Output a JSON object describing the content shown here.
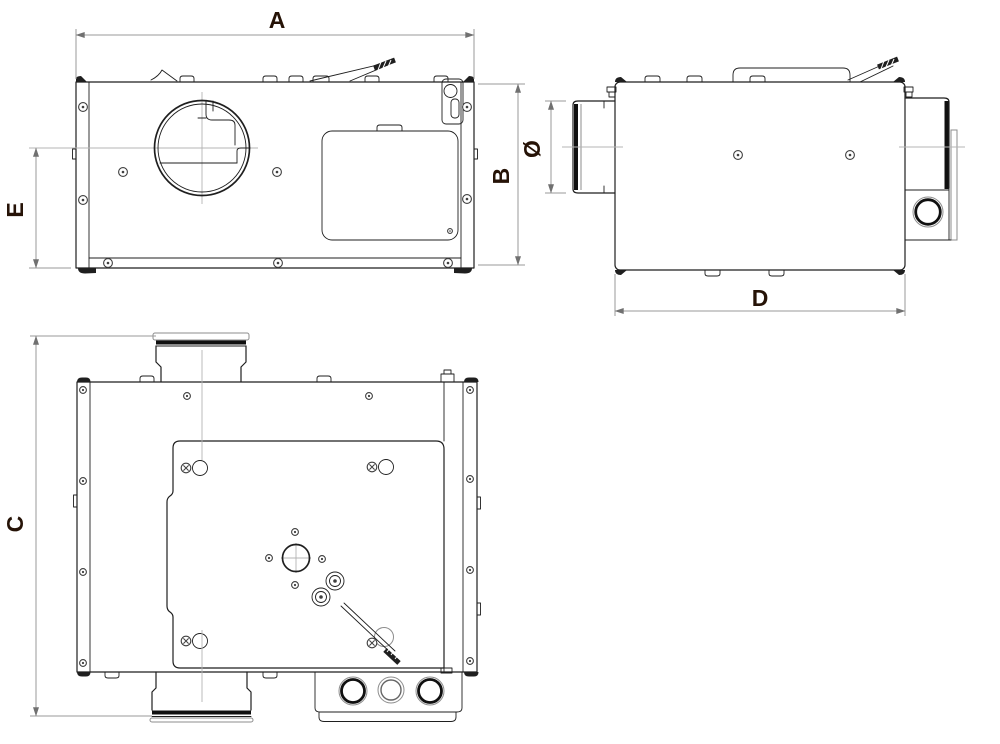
{
  "drawing": {
    "kind": "dimensioned-orthographic-views",
    "views": [
      {
        "id": "front-view",
        "dimensions_shown": [
          "A",
          "B",
          "E"
        ]
      },
      {
        "id": "side-view",
        "dimensions_shown": [
          "Ø",
          "D"
        ]
      },
      {
        "id": "bottom-view",
        "dimensions_shown": [
          "C"
        ]
      }
    ],
    "dimension_labels": {
      "a": "A",
      "b": "B",
      "c": "C",
      "d": "D",
      "e": "E",
      "diameter": "Ø"
    },
    "colors": {
      "background": "#ffffff",
      "label_text": "#261307",
      "object_line": "#1f1f1f",
      "dimension_line": "#9a9a9a",
      "arrow": "#707070",
      "centerline": "#b4b4b4",
      "seal_band": "#101010",
      "light_line": "#8d8d8d",
      "screw_line": "#3f3f3f",
      "mid_gray": "#666666"
    }
  }
}
